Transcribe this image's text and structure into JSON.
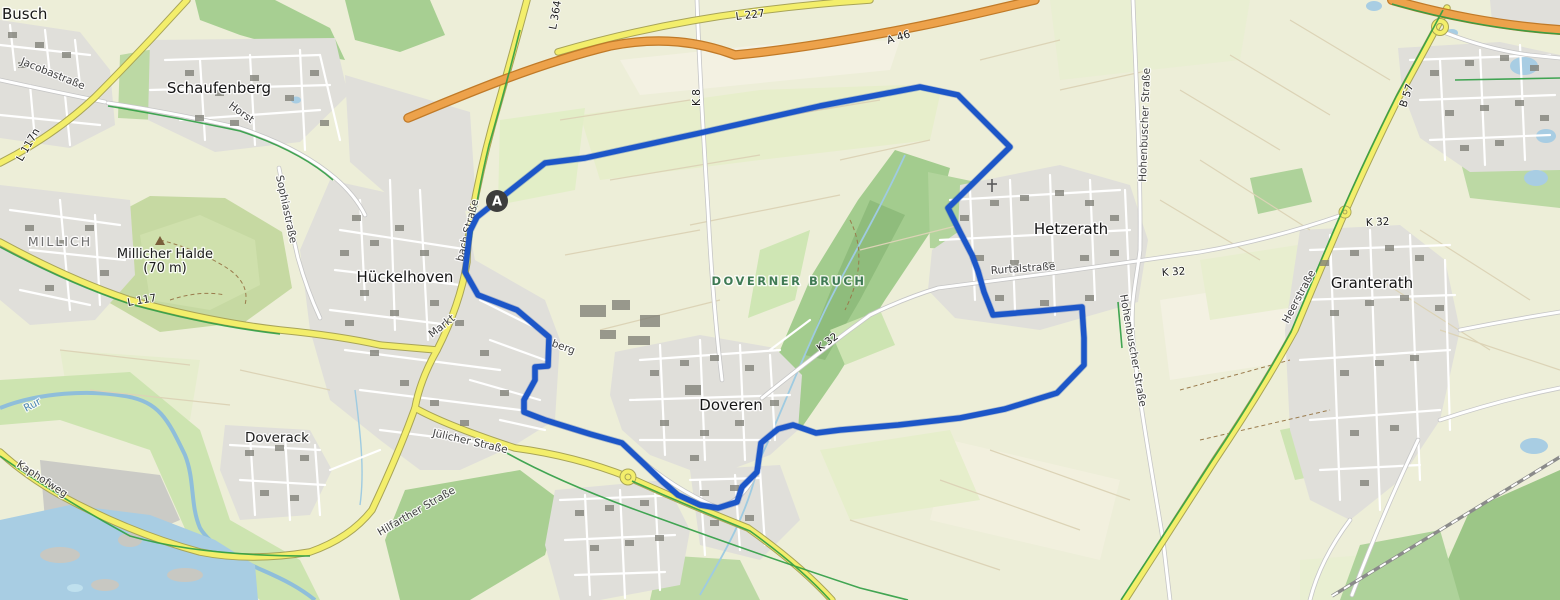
{
  "map": {
    "route": {
      "color": "#1c56c8",
      "points": [
        [
          497,
          201
        ],
        [
          545,
          163
        ],
        [
          585,
          158
        ],
        [
          700,
          133
        ],
        [
          820,
          106
        ],
        [
          920,
          87
        ],
        [
          958,
          95
        ],
        [
          1010,
          147
        ],
        [
          948,
          208
        ],
        [
          960,
          232
        ],
        [
          972,
          255
        ],
        [
          978,
          271
        ],
        [
          984,
          292
        ],
        [
          993,
          315
        ],
        [
          1040,
          311
        ],
        [
          1082,
          307
        ],
        [
          1084,
          338
        ],
        [
          1084,
          365
        ],
        [
          1057,
          393
        ],
        [
          1005,
          409
        ],
        [
          960,
          418
        ],
        [
          898,
          425
        ],
        [
          840,
          430
        ],
        [
          816,
          433
        ],
        [
          793,
          425
        ],
        [
          778,
          429
        ],
        [
          761,
          443
        ],
        [
          757,
          472
        ],
        [
          742,
          487
        ],
        [
          737,
          502
        ],
        [
          718,
          508
        ],
        [
          700,
          505
        ],
        [
          678,
          495
        ],
        [
          663,
          482
        ],
        [
          640,
          460
        ],
        [
          622,
          443
        ],
        [
          590,
          434
        ],
        [
          545,
          420
        ],
        [
          524,
          412
        ],
        [
          524,
          400
        ],
        [
          535,
          380
        ],
        [
          535,
          367
        ],
        [
          548,
          366
        ],
        [
          549,
          337
        ],
        [
          517,
          310
        ],
        [
          478,
          295
        ],
        [
          465,
          272
        ],
        [
          470,
          231
        ],
        [
          477,
          217
        ],
        [
          497,
          201
        ]
      ],
      "marker": {
        "label": "A",
        "x": 497,
        "y": 201
      }
    },
    "labels": {
      "towns": {
        "busch": "Busch",
        "schaufenberg": "Schaufenberg",
        "hueckelhoven": "Hückelhoven",
        "doveren": "Doveren",
        "hetzerath": "Hetzerath",
        "granterath": "Granterath",
        "doverack": "Doverack",
        "millich": "MILLICH"
      },
      "areas": {
        "doverner_bruch": "DOVERNER BRUCH",
        "millicher_halde": "Millicher Halde",
        "millicher_halde_elevation": "(70 m)"
      },
      "streets": {
        "jacobastrasse": "Jacobastraße",
        "sophiastrasse": "Sophiastraße",
        "horst": "Horst",
        "markt": "Markt",
        "bach_strasse": "bach Straße",
        "berg_fragment": "berg",
        "juelicher_strasse": "Jülicher Straße",
        "hilfarther_strasse": "Hilfarther Straße",
        "kaphofweg": "Kaphofweg",
        "rurtalstrasse": "Rurtalstraße",
        "hohenbuscher_strasse_north": "Hohenbuscher Straße",
        "hohenbuscher_strasse_south": "Hohenbuscher Straße",
        "heerstrasse": "Heerstraße"
      },
      "water": {
        "rur": "Rur"
      },
      "road_refs": {
        "l117n": "L 117n",
        "l117": "L 117",
        "l364": "L 364",
        "l227": "L 227",
        "a46": "A 46",
        "k8": "K 8",
        "k32_mid": "K 32",
        "k32_hetzerath": "K 32",
        "k32_granterath": "K 32",
        "b57": "B 57"
      }
    },
    "colors": {
      "route": "#1c56c8",
      "marker_bg": "#3d3d3d",
      "motorway": "#eda24b",
      "primary_road": "#f3ee6b",
      "minor_road": "#ffffff",
      "cycleway": "#2f9e44",
      "water": "#99c3dd",
      "forest": "#a9d08e",
      "farmland": "#edeed8",
      "residential": "#e0dfda"
    }
  }
}
